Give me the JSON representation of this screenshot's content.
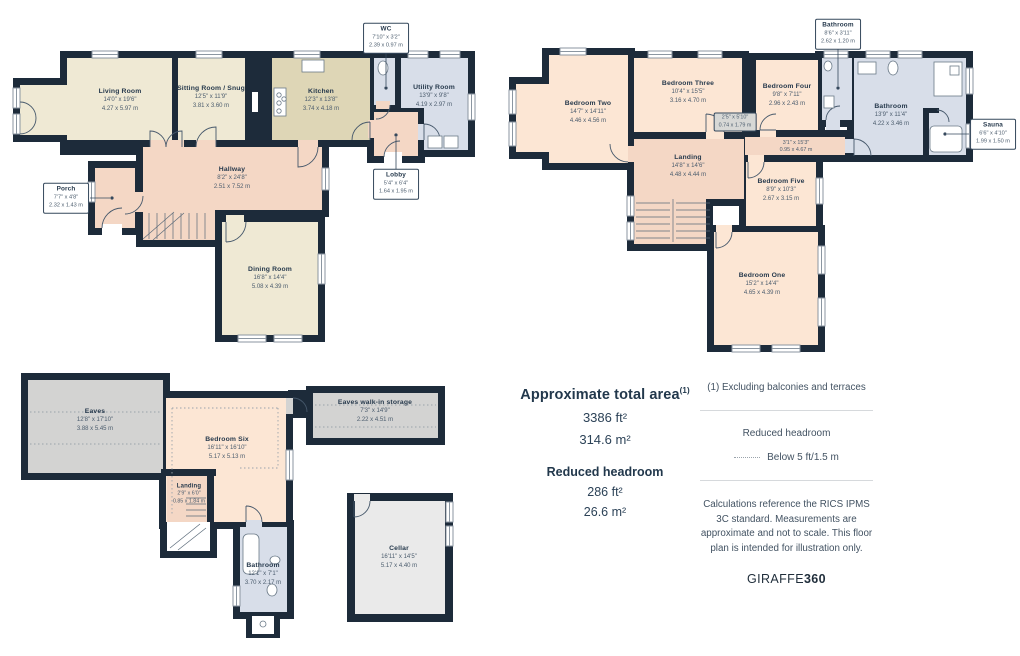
{
  "ground": {
    "living_room": {
      "name": "Living Room",
      "ft": "14'0\" x 19'6\"",
      "m": "4.27 x 5.97 m"
    },
    "sitting_room": {
      "name": "Sitting Room / Snug",
      "ft": "12'5\" x 11'9\"",
      "m": "3.81 x 3.60 m"
    },
    "kitchen": {
      "name": "Kitchen",
      "ft": "12'3\" x 13'8\"",
      "m": "3.74 x 4.18 m"
    },
    "wc": {
      "name": "WC",
      "ft": "7'10\" x 3'2\"",
      "m": "2.39 x 0.97 m"
    },
    "utility": {
      "name": "Utility Room",
      "ft": "13'9\" x 9'8\"",
      "m": "4.19 x 2.97 m"
    },
    "lobby": {
      "name": "Lobby",
      "ft": "5'4\" x 6'4\"",
      "m": "1.64 x 1.95 m"
    },
    "hallway": {
      "name": "Hallway",
      "ft": "8'2\" x 24'8\"",
      "m": "2.51 x 7.52 m"
    },
    "porch": {
      "name": "Porch",
      "ft": "7'7\" x 4'8\"",
      "m": "2.32 x 1.43 m"
    },
    "dining_room": {
      "name": "Dining Room",
      "ft": "16'8\" x 14'4\"",
      "m": "5.08 x 4.39 m"
    }
  },
  "first": {
    "bedroom_two": {
      "name": "Bedroom Two",
      "ft": "14'7\" x 14'11\"",
      "m": "4.46 x 4.56 m"
    },
    "bedroom_three": {
      "name": "Bedroom Three",
      "ft": "10'4\" x 15'5\"",
      "m": "3.16 x 4.70 m"
    },
    "bedroom_four": {
      "name": "Bedroom Four",
      "ft": "9'8\" x 7'11\"",
      "m": "2.96 x 2.43 m"
    },
    "bathroom_small": {
      "name": "Bathroom",
      "ft": "8'6\" x 3'11\"",
      "m": "2.62 x 1.20 m"
    },
    "bathroom": {
      "name": "Bathroom",
      "ft": "13'9\" x 11'4\"",
      "m": "4.22 x 3.46 m"
    },
    "sauna": {
      "name": "Sauna",
      "ft": "6'6\" x 4'10\"",
      "m": "1.99 x 1.50 m"
    },
    "closet": {
      "ft": "2'5\" x 5'10\"",
      "m": "0.74 x 1.79 m"
    },
    "corridor": {
      "ft": "3'1\" x 15'3\"",
      "m": "0.95 x 4.67 m"
    },
    "landing": {
      "name": "Landing",
      "ft": "14'8\" x 14'6\"",
      "m": "4.48 x 4.44 m"
    },
    "bedroom_five": {
      "name": "Bedroom Five",
      "ft": "8'9\" x 10'3\"",
      "m": "2.67 x 3.15 m"
    },
    "bedroom_one": {
      "name": "Bedroom One",
      "ft": "15'2\" x 14'4\"",
      "m": "4.65 x 4.39 m"
    }
  },
  "attic": {
    "eaves": {
      "name": "Eaves",
      "ft": "12'8\" x 17'10\"",
      "m": "3.88 x 5.45 m"
    },
    "bedroom_six": {
      "name": "Bedroom Six",
      "ft": "16'11\" x 16'10\"",
      "m": "5.17 x 5.13 m"
    },
    "storage": {
      "name": "Eaves walk-in storage",
      "ft": "7'3\" x 14'9\"",
      "m": "2.22 x 4.51 m"
    },
    "landing": {
      "name": "Landing",
      "ft": "2'9\" x 6'0\"",
      "m": "0.85 x 1.84 m"
    },
    "bathroom": {
      "name": "Bathroom",
      "ft": "12'1\" x 7'1\"",
      "m": "3.70 x 2.17 m"
    },
    "cellar": {
      "name": "Cellar",
      "ft": "16'11\" x 14'5\"",
      "m": "5.17 x 4.40 m"
    }
  },
  "summary": {
    "total_area_label": "Approximate total area",
    "total_area_sup": "(1)",
    "total_area_ft": "3386 ft²",
    "total_area_m": "314.6 m²",
    "reduced_headroom_label": "Reduced headroom",
    "reduced_headroom_ft": "286 ft²",
    "reduced_headroom_m": "26.6 m²"
  },
  "legend": {
    "footnote": "(1) Excluding balconies and terraces",
    "reduced_headroom_title": "Reduced headroom",
    "reduced_headroom_desc": "Below 5 ft/1.5 m",
    "disclaimer": "Calculations reference the RICS IPMS 3C standard. Measurements are approximate and not to scale. This floor plan is intended for illustration only.",
    "brand_regular": "GIRAFFE",
    "brand_bold": "360"
  },
  "colors": {
    "wall": "#1d2b3a",
    "cream": "#efe9d4",
    "khaki": "#ded6b6",
    "blue": "#d8dee9",
    "pink": "#f4d7c5",
    "peach": "#fce6d4",
    "gray": "#d3d3d2",
    "cellar": "#eaeaea"
  }
}
